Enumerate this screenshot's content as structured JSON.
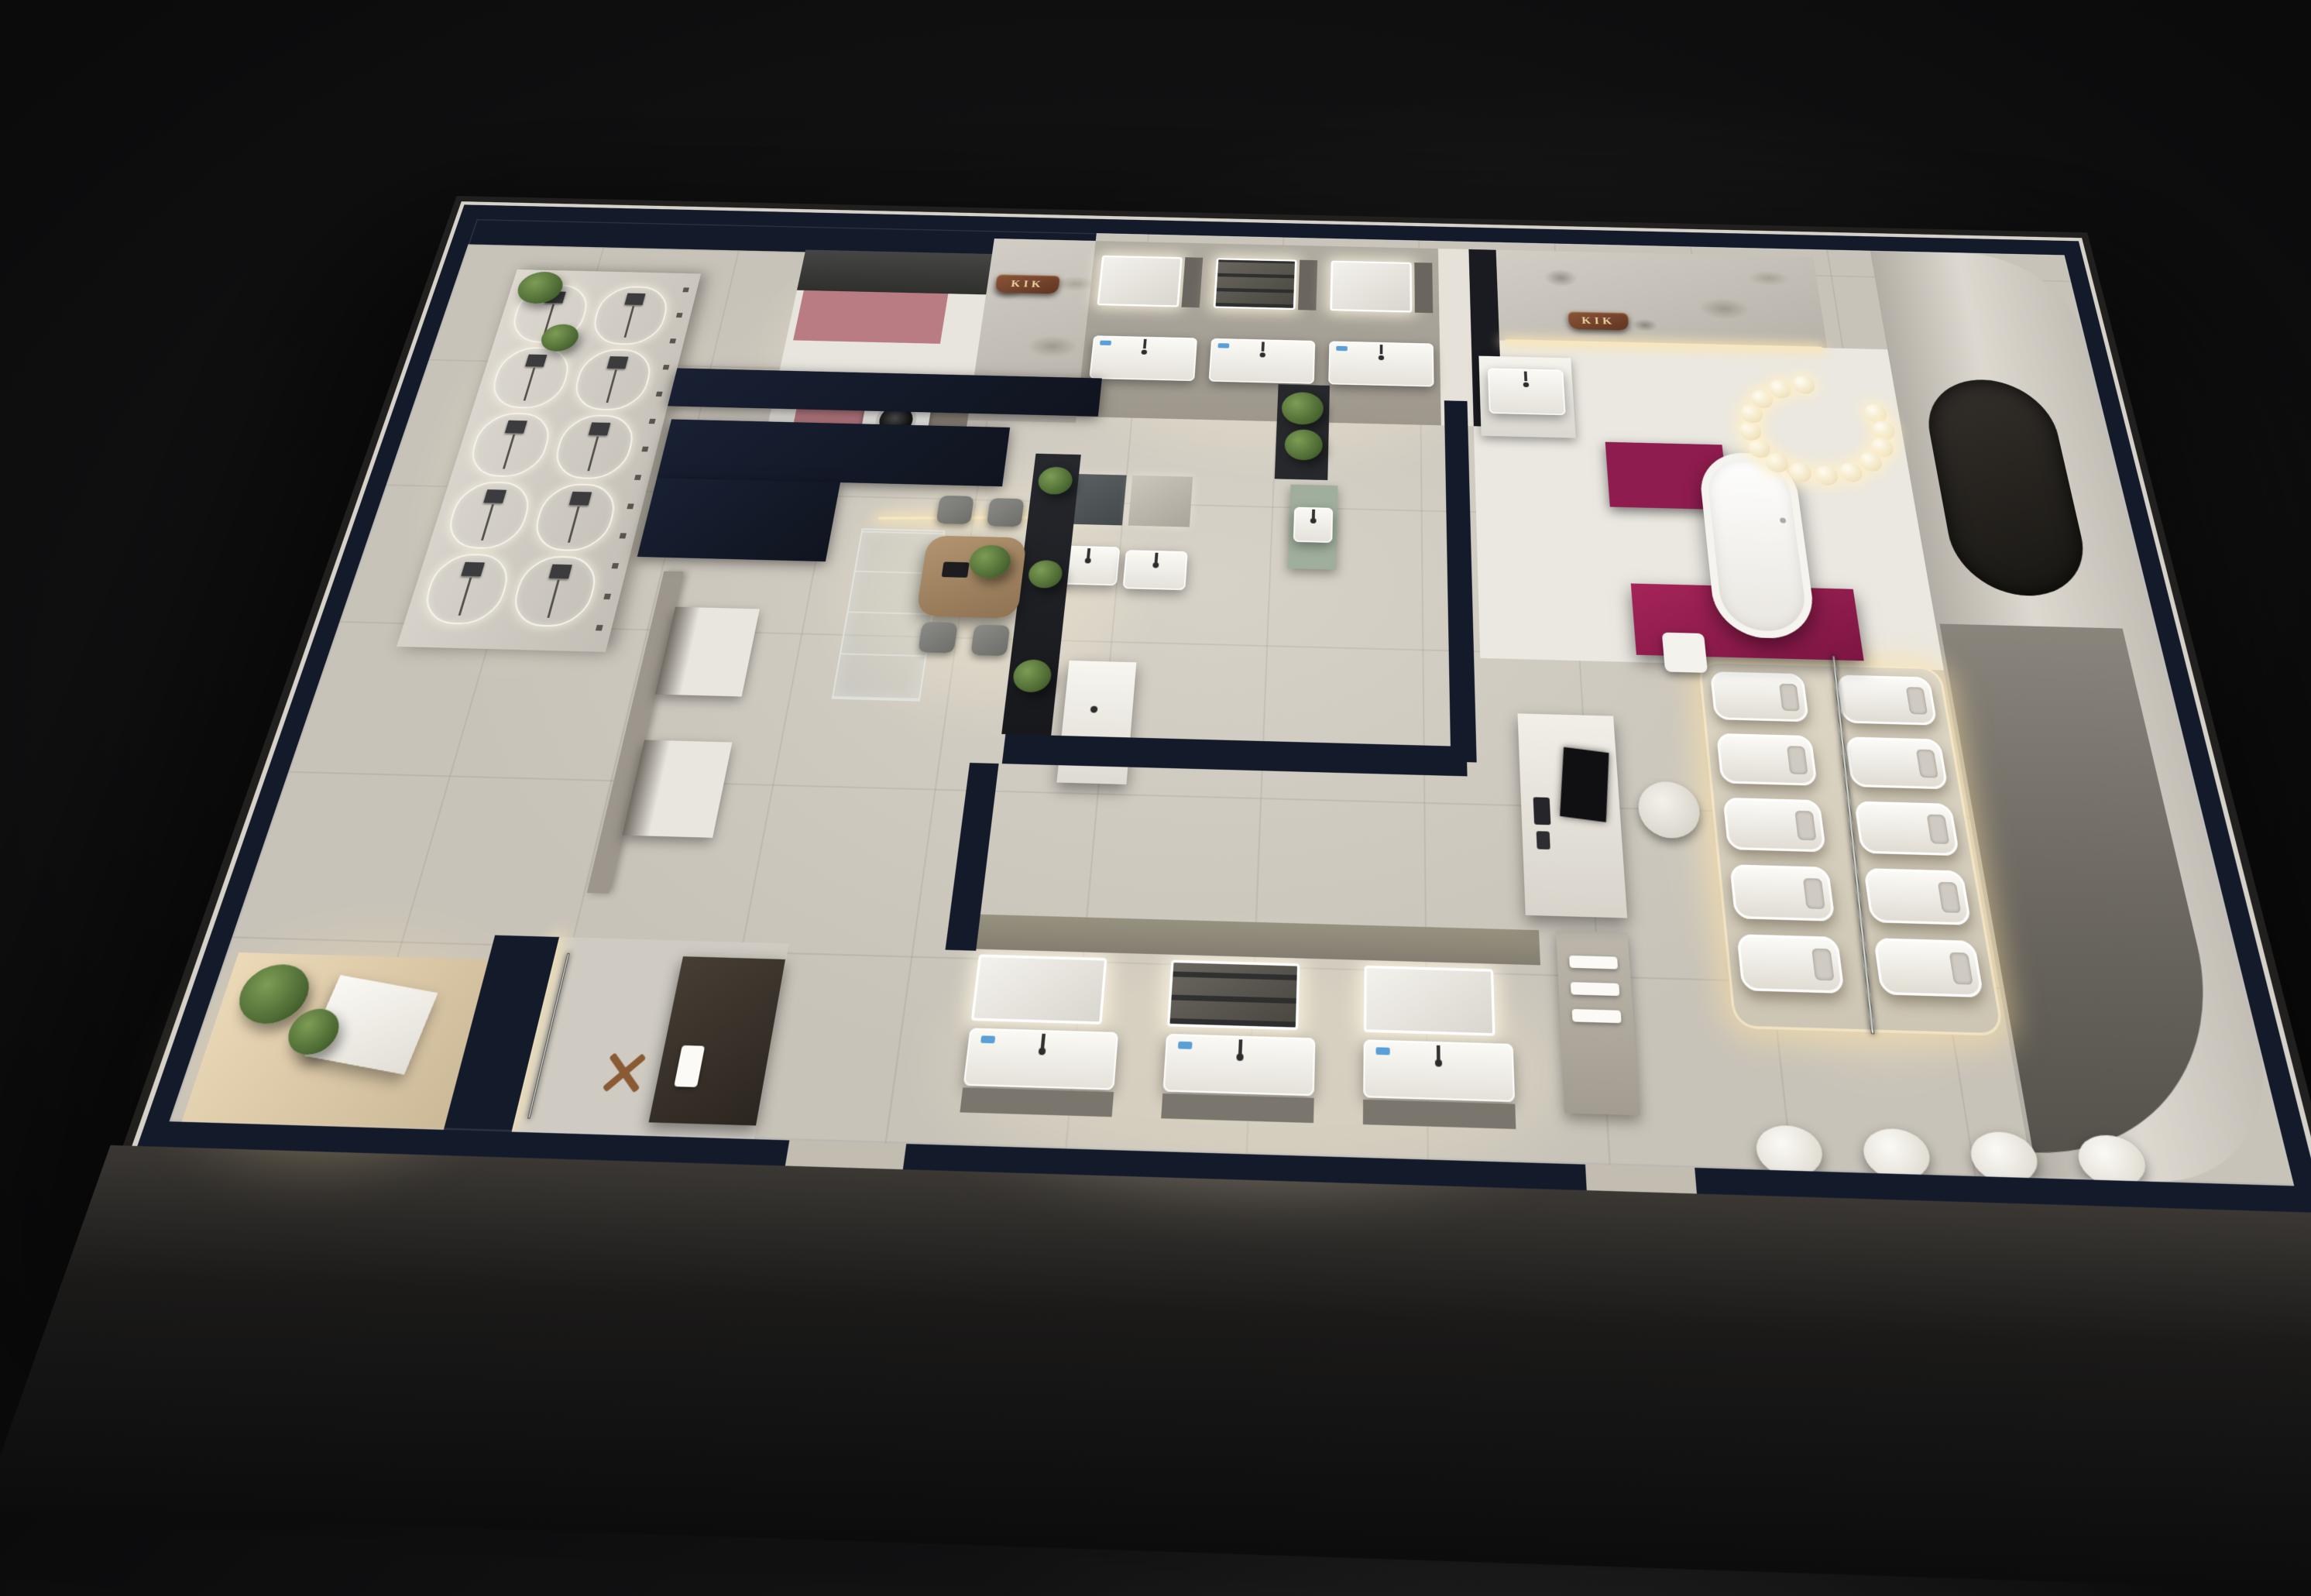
{
  "scene": {
    "description": "Night aerial 3D cutaway render of a KIK-brand bathroom fixture showroom floor plan",
    "signs": {
      "brand_wall_left": "KIK",
      "brand_wall_right": "KIK"
    },
    "theme": {
      "backdrop": "#0d0d0e",
      "wall_dark": "#131a2a",
      "wall_cap": "#d6d2c9",
      "floor": "#c8c3b9",
      "floor_light": "#eae7e0",
      "floor_warm": "#e3cfae",
      "counter_dark": "#3b3b39",
      "cabinet_taupe": "#8a8378",
      "accent_pink": "#b97c82",
      "accent_magenta": "#8f1c4e",
      "sage": "#9fae9d",
      "wood": "#a58a66",
      "copper": "#7c4b32",
      "gold": "#ecd3a2",
      "led": "#f6e7c0",
      "plant": "#5f7d44",
      "glass": "#b9c6c2",
      "fixture_white": "#f2f0ea"
    },
    "counts": {
      "shower_display_panels": 10,
      "top_vanity_bays": 3,
      "bottom_vanity_bays": 3,
      "toilet_rows": 5,
      "toilet_cols": 2,
      "ring_pendant_bulbs": 14,
      "front_wall_basins": 4,
      "dining_chairs": 4
    }
  }
}
